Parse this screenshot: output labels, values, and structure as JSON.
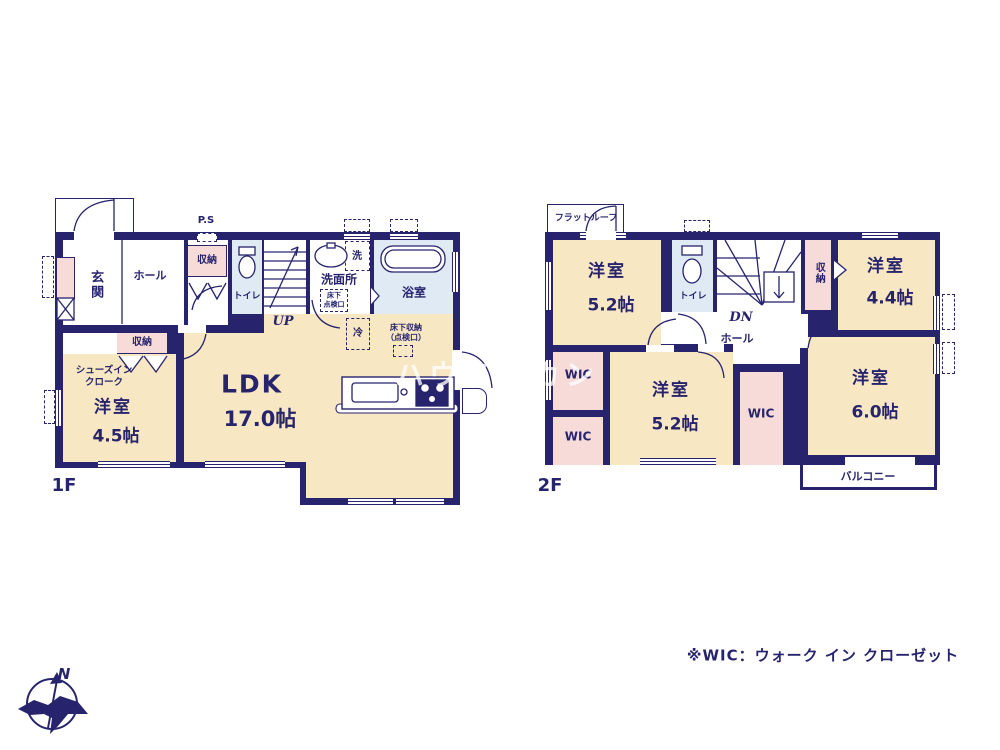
{
  "watermark": "ハウスボカン",
  "footnote": "※WIC：ウォーク イン クローゼット",
  "compass": {
    "north": "N"
  },
  "colors": {
    "wall_navy": "#27246d",
    "room_cream": "#f8e7c3",
    "closet_pink": "#f6dbd8",
    "wet_area_blue": "#dfeaf5",
    "watermark_white": "rgba(255,255,255,0.78)"
  },
  "floor1": {
    "label": "1F",
    "genkan": "玄関",
    "hall": "ホール",
    "storage_top": "収納",
    "ps": "P.S",
    "toilet": "トイレ",
    "up": "UP",
    "washroom": "洗面所",
    "hatch_line1": "床下",
    "hatch_line2": "点検口",
    "washer": "洗",
    "bath": "浴室",
    "fridge": "冷",
    "underfloor_line1": "床下収納",
    "underfloor_line2": "（点検口）",
    "ldk": "LDK",
    "ldk_size": "17.0帖",
    "storage_lower": "収納",
    "shoes_line1": "シューズイン",
    "shoes_line2": "クローク",
    "bedroom": "洋室",
    "bedroom_size": "4.5帖"
  },
  "floor2": {
    "label": "2F",
    "flat_roof": "フラットルーフ",
    "bedroom1": "洋室",
    "bedroom1_size": "5.2帖",
    "toilet": "トイレ",
    "dn": "DN",
    "hall": "ホール",
    "storage": "収納",
    "bedroom2": "洋室",
    "bedroom2_size": "4.4帖",
    "wic1": "WIC",
    "wic2": "WIC",
    "wic3": "WIC",
    "bedroom3": "洋室",
    "bedroom3_size": "5.2帖",
    "bedroom4": "洋室",
    "bedroom4_size": "6.0帖",
    "balcony": "バルコニー"
  }
}
